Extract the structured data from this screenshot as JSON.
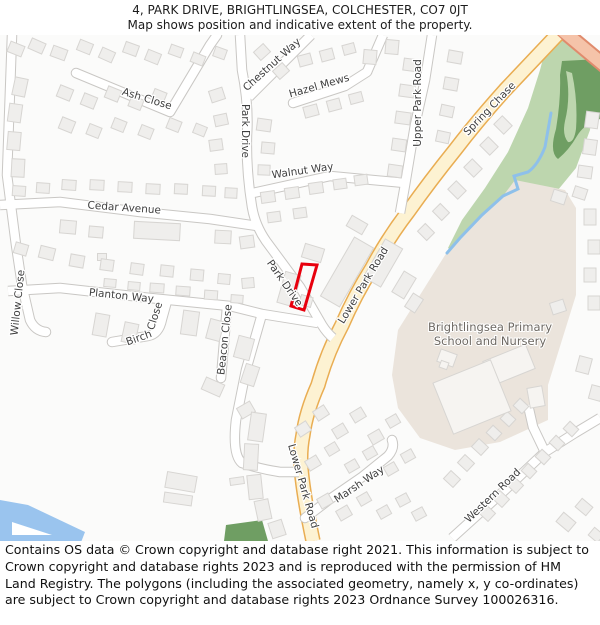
{
  "header": {
    "title": "4, PARK DRIVE, BRIGHTLINGSEA, COLCHESTER, CO7 0JT",
    "subtitle": "Map shows position and indicative extent of the property."
  },
  "footer": {
    "copyright": "Contains OS data © Crown copyright and database right 2021. This information is subject to Crown copyright and database rights 2023 and is reproduced with the permission of HM Land Registry. The polygons (including the associated geometry, namely x, y co-ordinates) are subject to Crown copyright and database rights 2023 Ordnance Survey 100026316."
  },
  "map": {
    "labels": {
      "chestnut_way": "Chestnut Way",
      "hazel_mews": "Hazel Mews",
      "ash_close": "Ash Close",
      "park_drive_upper": "Park Drive",
      "park_drive_lower": "Park Drive",
      "upper_park_road": "Upper Park Road",
      "walnut_way": "Walnut Way",
      "spring_chase": "Spring Chase",
      "cedar_avenue": "Cedar Avenue",
      "lower_park_road_upper": "Lower Park Road",
      "lower_park_road_lower": "Lower Park Road",
      "planton_way": "Planton Way",
      "willow_close": "Willow Close",
      "birch_label": "Birch",
      "birch_close_label": "Close",
      "beacon_close": "Beacon Close",
      "marsh_way": "Marsh Way",
      "western_road": "Western Road",
      "school_line1": "Brightlingsea Primary",
      "school_line2": "School and Nursery"
    },
    "property": {
      "polygon_points": "302,229 317,230 304,275 291,271",
      "outline_color": "#e8000d"
    },
    "colors": {
      "background": "#fbfbfa",
      "building": "#efeeec",
      "building_stroke": "#d7d5d2",
      "school_building": "#f6f4f1",
      "road_fill": "#ffffff",
      "road_casing": "#c9c7c4",
      "primary_road_fill": "#fdf2d2",
      "primary_road_casing": "#e9ad52",
      "salmon_road_fill": "#f5c3a9",
      "salmon_road_casing": "#e08b6d",
      "park_green": "#bdd6ae",
      "wood_green": "#6f9e63",
      "school_ground": "#ebe4dc",
      "water": "#9ac4ee",
      "stream": "#8ec0ea"
    }
  }
}
